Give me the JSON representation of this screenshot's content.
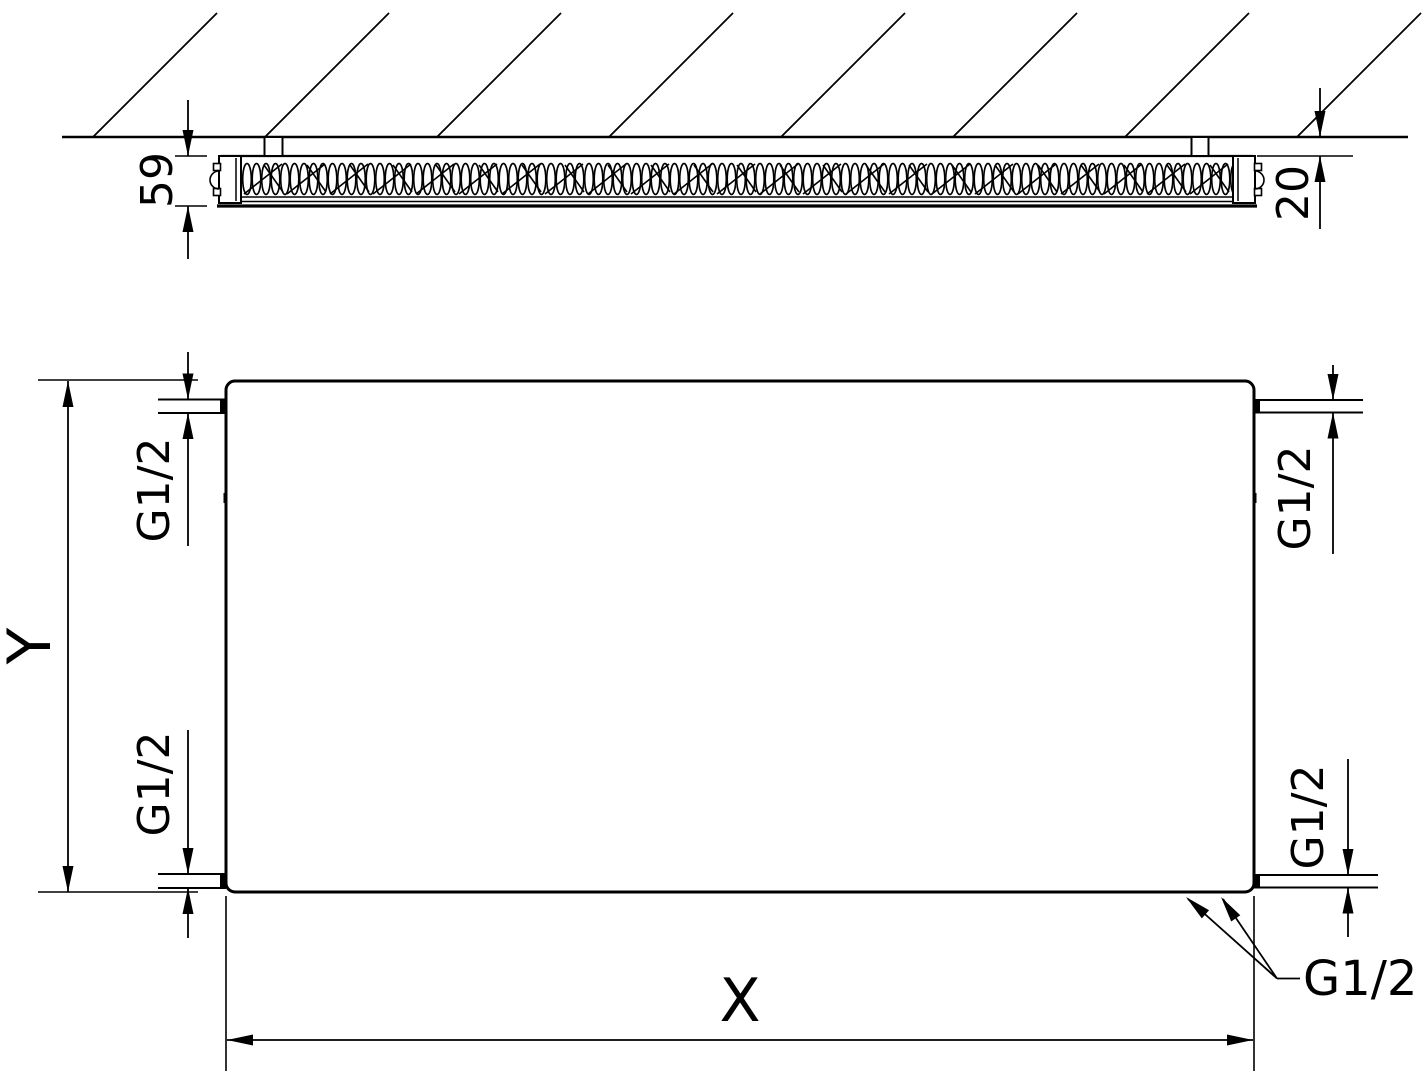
{
  "drawing": {
    "description": "Technical dimension drawing of a flat panel radiator: side cross-section at wall (top) and front elevation (bottom)",
    "line_color": "#000000",
    "background_color": "#ffffff",
    "side_view": {
      "depth_label": "59",
      "wall_distance_label": "20"
    },
    "front_view": {
      "width_label": "X",
      "height_label": "Y",
      "connections": {
        "top_left": "G1/2",
        "bottom_left": "G1/2",
        "top_right": "G1/2",
        "bottom_right": "G1/2",
        "bottom_callout": "G1/2"
      }
    }
  }
}
